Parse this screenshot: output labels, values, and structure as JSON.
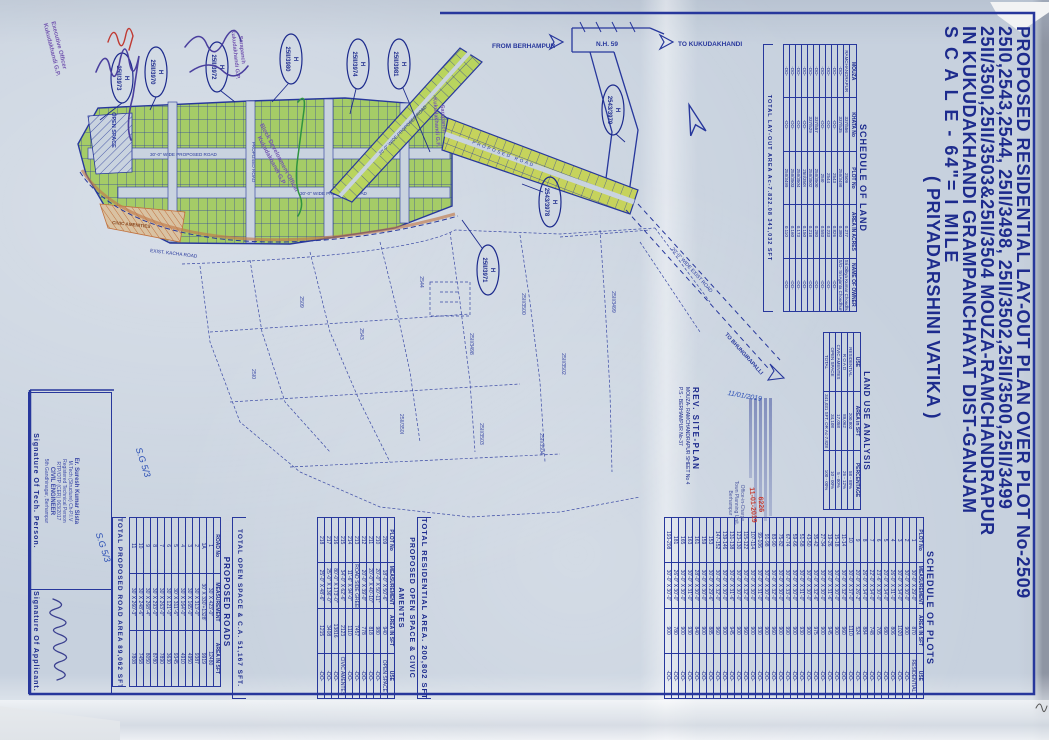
{
  "title_block": {
    "line1": "PROPOSED RESIDENTIAL LAY-OUT PLAN OVER PLOT No-2509",
    "line2": "25I0,2543,2544, 25II/3498, 25II/3502,25II/3500,25II/3499",
    "line3": "25II/350I,25II/3503&25II/3504 MOUZA-RAMCHANDRAPUR",
    "line4": "IN KUKUDAKHANDI GRAMPANCHAYAT DIST-GANJAM",
    "line5": "S C A L E -  64\"= I MILE",
    "line6": "( PRIYADARSHINI  VATIKA )"
  },
  "map": {
    "from_berhampur": "FROM BERHAMPUR",
    "nh59": "N.H. 59",
    "to_kukudakhandi": "TO KUKUDAKHANDI",
    "to_bhungirapalli": "TO BHUNGIRAPALLI",
    "exist_road": "20'-0\" WIDE EXIST ROAD",
    "proposed_road_30": "30'-0\" WIDE PROPOSED ROAD",
    "proposed_road_20": "20'-0\" WIDE PROPOSED ROAD",
    "proposed_road": "PROPOSED ROAD",
    "kacha_road": "EXIST. KACHA ROAD",
    "open_space": "OPEN SPACE",
    "civic_amenities": "CIVIC AMENITIES",
    "callout_prefix": "H",
    "callouts": [
      {
        "plot": "25II/3973"
      },
      {
        "plot": "25II/3970"
      },
      {
        "plot": "25II/3972"
      },
      {
        "plot": "25II/3980"
      },
      {
        "plot": "25II/3974"
      },
      {
        "plot": "25II/3981"
      },
      {
        "plot": "2543/3979"
      },
      {
        "plot": "2543/3978"
      },
      {
        "plot": "25II/3971"
      }
    ],
    "cadastral_plots": [
      "2509",
      "25I0",
      "2543",
      "2544",
      "25II/3498",
      "25II/3500",
      "25II/3502",
      "25II/350I",
      "25II/3503",
      "25II/3504",
      "25II/3499"
    ],
    "note_sg": "S.G 5/3"
  },
  "schedule_of_land": {
    "title": "SCHEDULE OF LAND",
    "columns": [
      "MOUZA",
      "KHATA No",
      "PLOT No",
      "AREA IN ACRES",
      "NAME OF OWNER"
    ],
    "rows": [
      [
        "RAMCHANDRAPUR",
        "337/556",
        "2509",
        "0.277",
        "Sri Dibya Kumar Choudhury"
      ],
      [
        "-DO-",
        "337/535",
        "25II/3498",
        "0.380",
        "S/O- Sri Ajanta Choudhury"
      ],
      [
        "-DO-",
        "-DO-",
        "2543",
        "0.826",
        "-DO-"
      ],
      [
        "-DO-",
        "-DO-",
        "2544",
        "0.233",
        "-DO-"
      ],
      [
        "-DO-",
        "-DO-",
        "25I0",
        "0.593",
        "-DO-"
      ],
      [
        "-DO-",
        "337/557",
        "25II/3500",
        "0.280",
        "-DO-"
      ],
      [
        "-DO-",
        "337/529",
        "25II/3502",
        "0.218",
        "-DO-"
      ],
      [
        "-DO-",
        "-DO-",
        "25II/350I",
        "0.150",
        "-DO-"
      ],
      [
        "-DO-",
        "-DO-",
        "25II/3504",
        "0.173",
        "-DO-"
      ],
      [
        "-DO-",
        "-DO-",
        "25II/3503",
        "0.160",
        "-DO-"
      ],
      [
        "-DO-",
        "-DO-",
        "25II/3499",
        "0.110",
        "-DO-"
      ]
    ],
    "total": "TOTAL LAY-OUT AREA    Ac-7.822.08    341,032 SFT"
  },
  "land_use_analysis": {
    "title": "LAND USE ANALYSIS",
    "columns": [
      "USE",
      "AREA in SFT",
      "PERCENTAGE"
    ],
    "rows": [
      [
        "RESIDENTIAL",
        "200,802",
        "58 - 88%"
      ],
      [
        "R O A D",
        "89,062",
        "26 - 12%"
      ],
      [
        "CIVIC AMENTES",
        "17,058",
        "5 - 00%"
      ],
      [
        "OPEN SPACE",
        "34,108",
        "10 - 00%"
      ],
      [
        "TOTAL",
        "341,031 SFT. OR Ac-7.828",
        "100 - 00%"
      ]
    ]
  },
  "schedule_of_plots": {
    "title": "SCHEDULE OF PLOTS",
    "columns": [
      "PLOT No",
      "MEASUREMENT",
      "AREA IN SFT",
      "USE"
    ],
    "rows": [
      [
        "1",
        "30'-0\" X 29'-0\"",
        "870",
        "RESIDENTIAL"
      ],
      [
        "2",
        "30'-0\" X 30'-0\"",
        "900",
        "-DO-"
      ],
      [
        "3",
        "30'-0\" X 34'-0\"",
        "1020",
        "-DO-"
      ],
      [
        "4",
        "26'-0\" X 31'-0\"",
        "806",
        "-DO-"
      ],
      [
        "5",
        "20'-0\" X 34'-0\"",
        "680",
        "-DO-"
      ],
      [
        "6",
        "23'-6\" X 30'-0\"",
        "705",
        "-DO-"
      ],
      [
        "7",
        "22'-0\" X 34'-0\"",
        "748",
        "-DO-"
      ],
      [
        "8",
        "26'-0\" X 34'-0\"",
        "884",
        "-DO-"
      ],
      [
        "9",
        "20'-0\" X 26'-2\"",
        "524",
        "-DO-"
      ],
      [
        "10",
        "30'-0\" X 37'-0\"",
        "1110",
        "-DO-"
      ],
      [
        "11-14",
        "30'-0\" X 32'-0\"",
        "960",
        "-DO-"
      ],
      [
        "15-18",
        "30'-0\" X 30'-0\"",
        "900",
        "-DO-"
      ],
      [
        "19-26",
        "30'-0\" X 31'-6\"",
        "945",
        "-DO-"
      ],
      [
        "27-34",
        "30'-0\" X 30'-0\"",
        "900",
        "-DO-"
      ],
      [
        "35-42",
        "30'-0\" X 32'-6\"",
        "975",
        "-DO-"
      ],
      [
        "43-50",
        "30'-0\" X 30'-0\"",
        "900",
        "-DO-"
      ],
      [
        "51-58",
        "30'-0\" X 31'-0\"",
        "930",
        "-DO-"
      ],
      [
        "59-66",
        "30'-0\" X 30'-0\"",
        "900",
        "-DO-"
      ],
      [
        "67-74",
        "30'-0\" X 33'-0\"",
        "990",
        "-DO-"
      ],
      [
        "75-82",
        "30'-0\" X 30'-0\"",
        "900",
        "-DO-"
      ],
      [
        "83-90",
        "30'-0\" X 32'-0\"",
        "960",
        "-DO-"
      ],
      [
        "91-98",
        "30'-0\" X 30'-0\"",
        "900",
        "-DO-"
      ],
      [
        "99-106",
        "30'-0\" X 31'-0\"",
        "930",
        "-DO-"
      ],
      [
        "107-114",
        "30'-0\" X 30'-0\"",
        "900",
        "-DO-"
      ],
      [
        "115-122",
        "30'-0\" X 32'-0\"",
        "960",
        "-DO-"
      ],
      [
        "123-130",
        "30'-0\" X 30'-0\"",
        "900",
        "-DO-"
      ],
      [
        "131-138",
        "30'-0\" X 31'-6\"",
        "945",
        "-DO-"
      ],
      [
        "139-146",
        "30'-0\" X 30'-0\"",
        "900",
        "-DO-"
      ],
      [
        "147-152",
        "30'-0\" X 32'-0\"",
        "960",
        "-DO-"
      ],
      [
        "153",
        "30'-0\" X 29'-6\"",
        "885",
        "-DO-"
      ],
      [
        "159",
        "30'-0\" X 30'-0\"",
        "900",
        "-DO-"
      ],
      [
        "161",
        "28'-0\" X 30'-0\"",
        "840",
        "-DO-"
      ],
      [
        "163",
        "30'-0\" X 31'-0\"",
        "930",
        "-DO-"
      ],
      [
        "165",
        "30'-0\" X 30'-0\"",
        "900",
        "-DO-"
      ],
      [
        "181",
        "26'-0\" X 30'-0\"",
        "780",
        "-DO-"
      ],
      [
        "193-208",
        "30'-0\" X 30'-0\"",
        "900",
        "-DO-"
      ]
    ],
    "total": "TOTAL RESIDENTIAL AREA. 200,802 SFT."
  },
  "open_space_table": {
    "title": "PROPOSED OPEN SPACE & CIVIC AMENTES",
    "columns": [
      "PLOT No",
      "MEASUREMENT",
      "AREA IN SFT",
      "USE"
    ],
    "rows": [
      [
        "209",
        "18'-0\" X 50'-6\"",
        "940",
        "OPEN SPACE"
      ],
      [
        "210",
        "20'-0\" X 50'-11\"",
        "980",
        "-DO-"
      ],
      [
        "211",
        "20'-0\" X 40'-10\"",
        "818",
        "-DO-"
      ],
      [
        "212",
        "20'-0\" X 39'-0\"",
        "778",
        "-DO-"
      ],
      [
        "213",
        "ROAD SIDE GREENERY",
        "7457",
        "-DO-"
      ],
      [
        "214",
        "11'-6\" X 94'-0\"",
        "1110",
        "-DO-"
      ],
      [
        "215",
        "34'-0\" X 62'-6\"",
        "2123",
        "CIVIC AMENTES"
      ],
      [
        "216",
        "80'-0\" X 173'-0\"",
        "13816",
        "-DO-"
      ],
      [
        "217",
        "25'-0\" X 136'-0\"",
        "3408",
        "-DO-"
      ],
      [
        "218",
        "25'-0\" X 48'-6\"",
        "1215",
        "-DO-"
      ]
    ],
    "total": "TOTAL OPEN SPACE & C.A.  51,167 SFT."
  },
  "roads_table": {
    "title": "PROPOSED ROADS",
    "columns": [
      "ROAD No",
      "MEASUREMENT",
      "AREA IN SFT"
    ],
    "rows": [
      [
        "1",
        "30' X 423'-0\"",
        "12480"
      ],
      [
        "1A",
        "30' X 330'+1328'",
        "9919"
      ],
      [
        "2",
        "30' X 313'-0\"",
        "9387"
      ],
      [
        "3",
        "30' X 165'-0\"",
        "4950"
      ],
      [
        "4",
        "30' X 164'-0\"",
        "4910"
      ],
      [
        "5",
        "30' X 311'-6\"",
        "9345"
      ],
      [
        "6",
        "30' X 121'-0\"",
        "3630"
      ],
      [
        "7",
        "30' X 263'-0\"",
        "7890"
      ],
      [
        "8",
        "30' X 293'-0\"",
        "8780"
      ],
      [
        "9",
        "30' X 268'-4\"",
        "8050"
      ],
      [
        "10",
        "30' X 248'-6\"",
        "7458"
      ],
      [
        "11",
        "30' X 260'-3\"",
        "7808"
      ]
    ],
    "total": "TOTAL PROPOSED ROAD AREA 89,062 SFT."
  },
  "rev_site_plan": {
    "heading": "REV. SITE-PLAN",
    "line1": "MOUZA- RAMCHANDRAPUR SHEET No 4",
    "line2": "P.S - BERHAMPUR No-37"
  },
  "approval": {
    "office_line1": "Office-in-Charge",
    "office_line2": "Town Planning Unit,",
    "office_line3": "Berhampur",
    "stamp_no": "6226",
    "stamp_date": "11-01-2019",
    "handwritten_date": "11/01/2019"
  },
  "signatures": {
    "applicant_label": "Signature Of Applicant.",
    "tech_label": "Signature Of Tech. Person.",
    "tech_stamp": {
      "name": "Er. Suresh Kumar Sista",
      "qual": "M.Tech (Structure) Ch-P.I.V",
      "reg": "Registered Technical Person",
      "regno": "RTP/OTP (CER) 063/2017",
      "role": "CIVIL ENGINEER",
      "addr": "5th Gandhinagar, Berhampur"
    }
  },
  "stamps": {
    "executive1": "Executive Officer",
    "executive2": "Kukudakhandi G.P.",
    "bdo1": "Block Development Officer",
    "bdo2": "Kukudakhandi G.P.",
    "sarpanch1": "Sarapanch",
    "sarpanch2": "Kukudakhandi G.P."
  }
}
